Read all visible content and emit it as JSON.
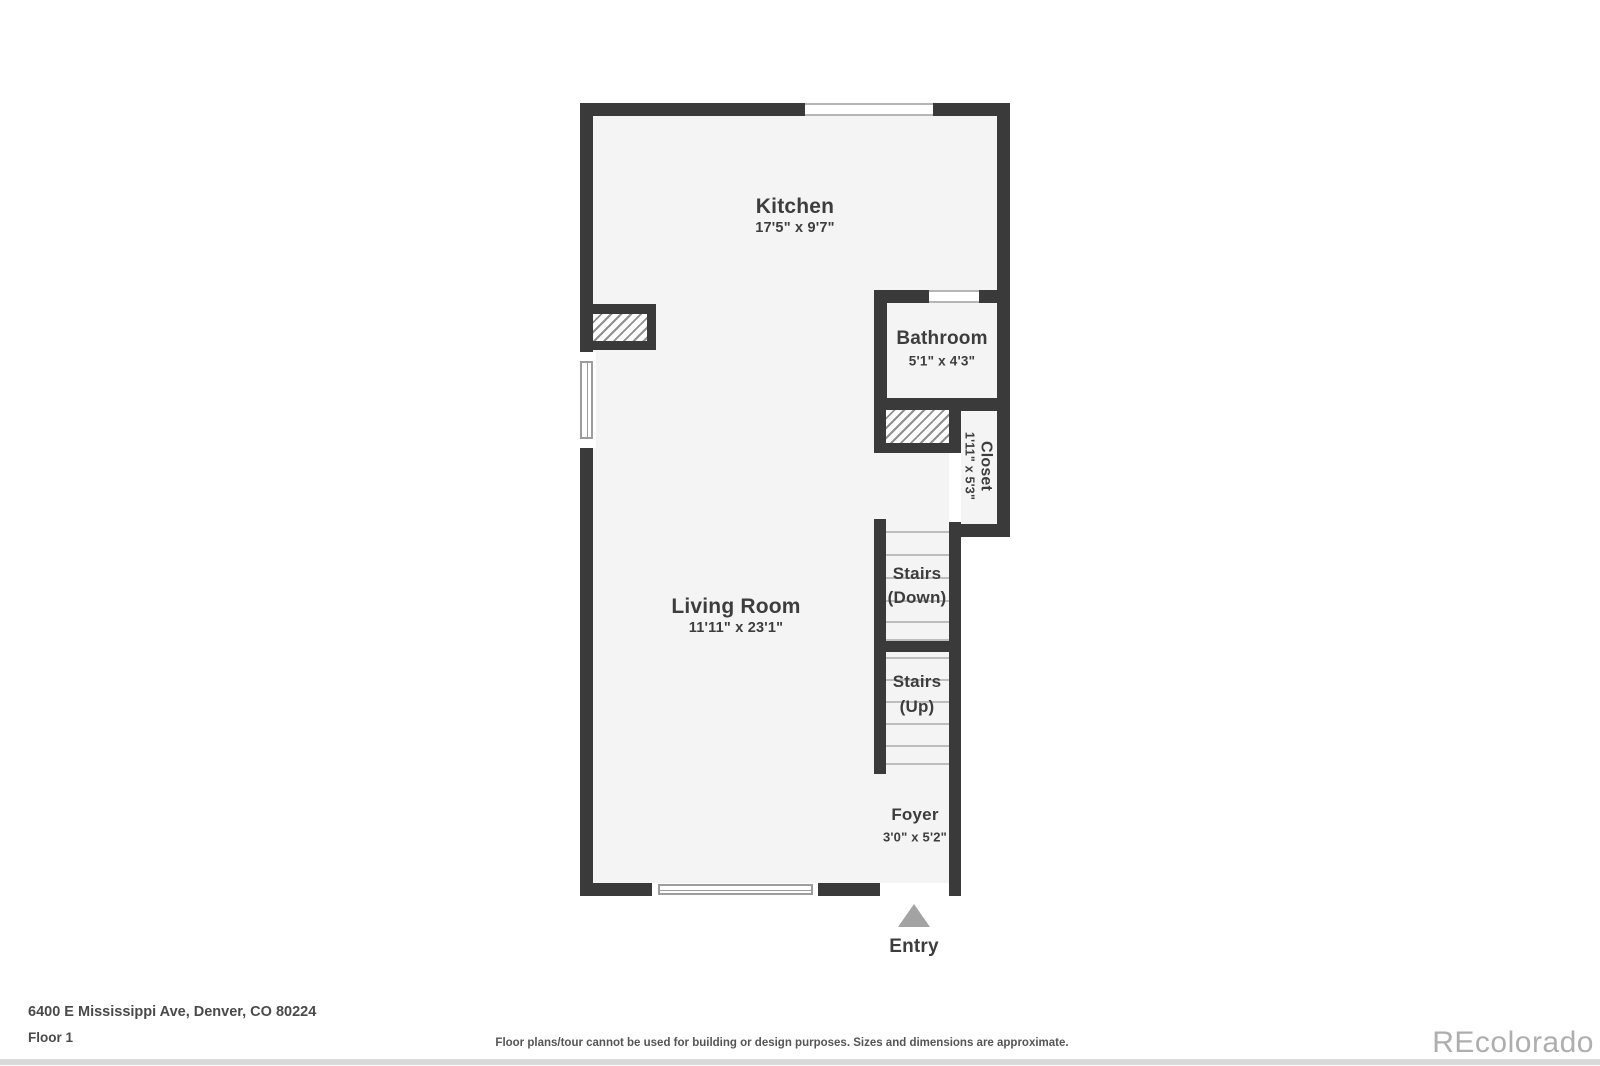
{
  "plan": {
    "rooms": {
      "kitchen": {
        "name": "Kitchen",
        "dims": "17'5\" x 9'7\""
      },
      "bathroom": {
        "name": "Bathroom",
        "dims": "5'1\" x 4'3\""
      },
      "closet": {
        "name": "Closet",
        "dims": "1'11\" x 5'3\""
      },
      "living_room": {
        "name": "Living Room",
        "dims": "11'11\" x 23'1\""
      },
      "stairs_down": {
        "line1": "Stairs",
        "line2": "(Down)"
      },
      "stairs_up": {
        "line1": "Stairs",
        "line2": "(Up)"
      },
      "foyer": {
        "name": "Foyer",
        "dims": "3'0\" x 5'2\""
      }
    },
    "entry": {
      "label": "Entry"
    }
  },
  "footer": {
    "address": "6400 E Mississippi Ave, Denver, CO 80224",
    "floor_label": "Floor 1",
    "disclaimer": "Floor plans/tour cannot be used for building or design purposes. Sizes and dimensions are approximate.",
    "watermark": "REcolorado"
  },
  "colors": {
    "wall": "#3a3a3a",
    "floor_fill": "#f4f4f4",
    "tread_line": "#bdbdbd",
    "label_text": "#3d3d3d",
    "entry_arrow": "#a3a3a3",
    "watermark_text": "#aeaeae",
    "bottom_strip": "#d9d9d9"
  }
}
